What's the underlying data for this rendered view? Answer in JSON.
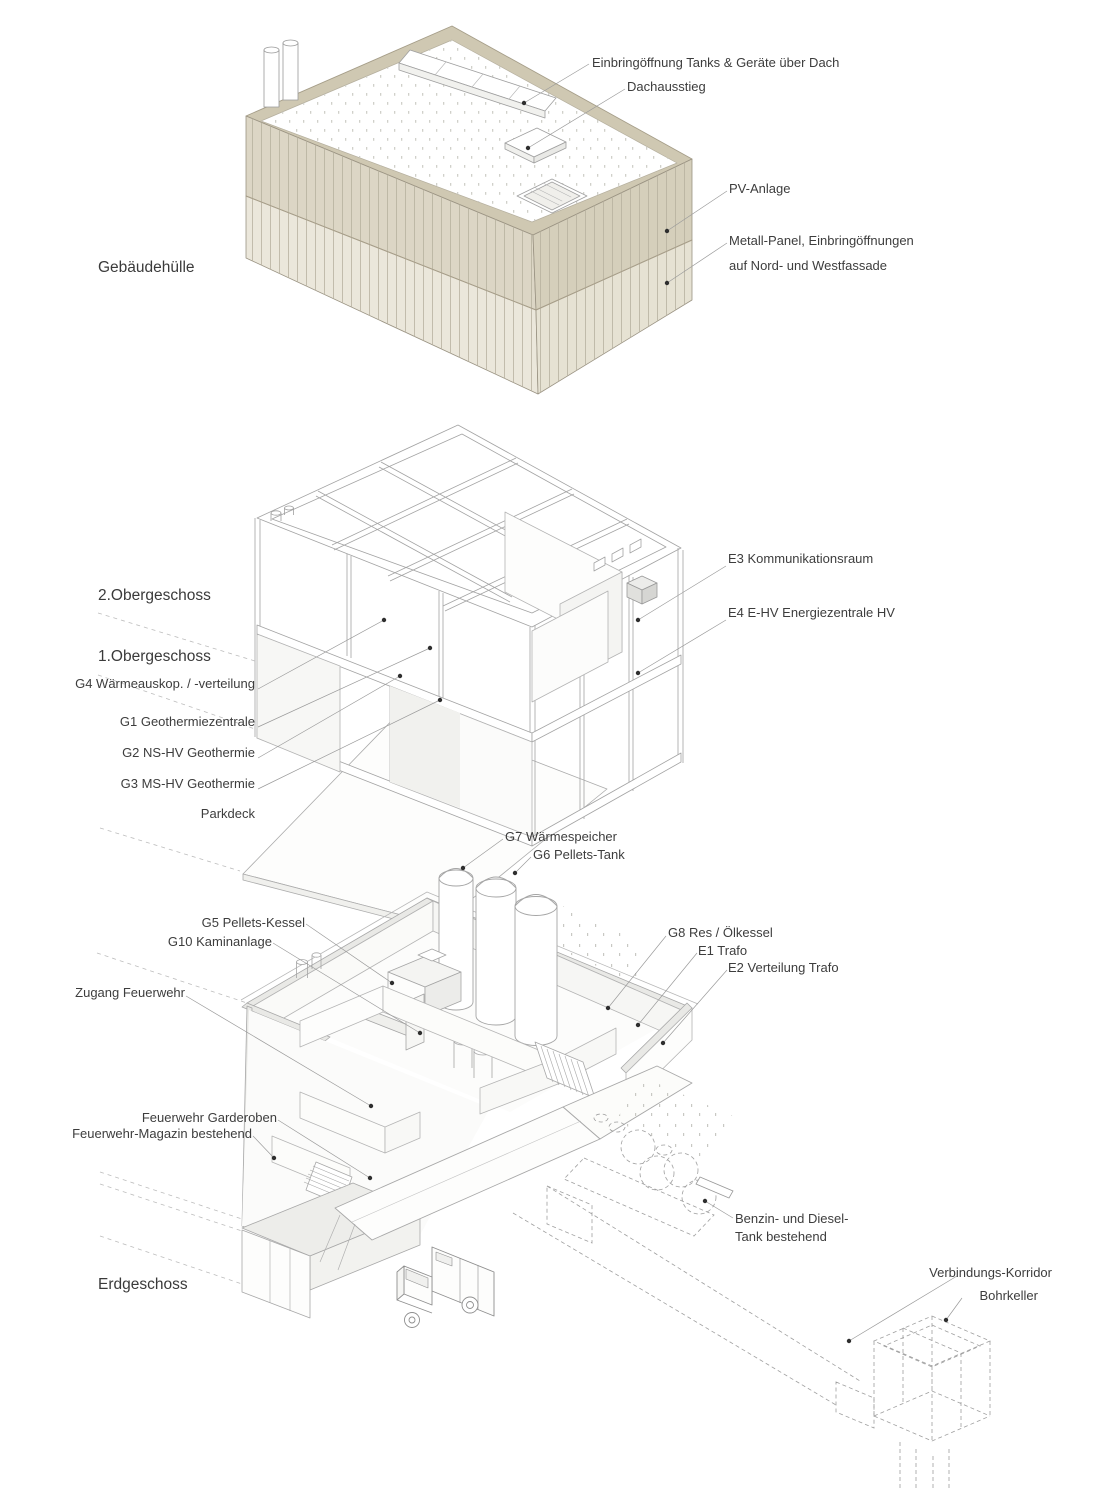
{
  "diagram_title": "Exploded axonometric – Energiezentrale / Feuerwehr",
  "colors": {
    "facade_upper": "#d9d3c2",
    "facade_lower": "#ebe7db",
    "facade_rim": "#cfc8b2",
    "facade_side_upper": "#d5cfbb",
    "facade_side_lower": "#e6e2d3",
    "line": "#a5a5a5",
    "leader": "#9a9a9a",
    "dot": "#2e2e2e",
    "label_text": "#3d3d3d"
  },
  "sections": {
    "envelope": {
      "title": "Gebäudehülle",
      "labels": {
        "einbringoeffnung": "Einbringöffnung Tanks & Geräte über Dach",
        "dachausstieg": "Dachausstieg",
        "pv": "PV-Anlage",
        "metall_1": "Metall-Panel, Einbringöffnungen",
        "metall_2": "auf Nord- und Westfassade"
      }
    },
    "upper_floors": {
      "title_2og": "2.Obergeschoss",
      "title_1og": "1.Obergeschoss",
      "labels": {
        "e3": "E3 Kommunikationsraum",
        "e4": "E4 E-HV Energiezentrale HV",
        "g4": "G4 Wärmeauskop. / -verteilung",
        "g1": "G1 Geothermiezentrale",
        "g2": "G2 NS-HV Geothermie",
        "g3": "G3 MS-HV Geothermie",
        "parkdeck": "Parkdeck"
      }
    },
    "ground_floor": {
      "title": "Erdgeschoss",
      "labels": {
        "g7": "G7 Wärmespeicher",
        "g6": "G6 Pellets-Tank",
        "g5": "G5 Pellets-Kessel",
        "g10": "G10 Kaminanlage",
        "zugang": "Zugang Feuerwehr",
        "g8": "G8 Res / Ölkessel",
        "e1": "E1 Trafo",
        "e2": "E2 Verteilung Trafo",
        "garderoben": "Feuerwehr Garderoben",
        "magazin": "Feuerwehr-Magazin bestehend",
        "benzin_1": "Benzin- und Diesel-",
        "benzin_2": "Tank bestehend",
        "korridor": "Verbindungs-Korridor",
        "bohrkeller": "Bohrkeller"
      }
    }
  }
}
